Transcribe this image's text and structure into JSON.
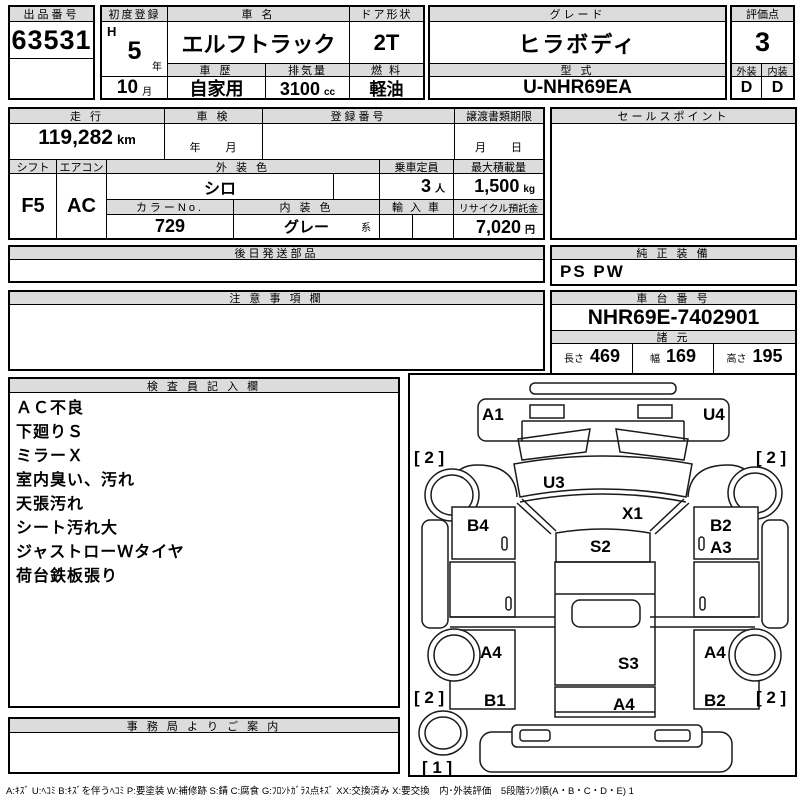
{
  "top": {
    "lot": {
      "label": "出品番号",
      "value": "63531"
    },
    "first_reg": {
      "label": "初度登録",
      "era": "H",
      "year": "5",
      "year_unit": "年",
      "month": "10",
      "month_unit": "月"
    },
    "car_name": {
      "label": "車 名",
      "value": "エルフトラック"
    },
    "history": {
      "label": "車 歴",
      "value": "自家用"
    },
    "displacement": {
      "label": "排気量",
      "value": "3100",
      "unit": "cc"
    },
    "door": {
      "label": "ドア形状",
      "value": "2T"
    },
    "fuel": {
      "label": "燃 料",
      "value": "軽油"
    },
    "grade": {
      "label": "グレード",
      "value": "ヒラボディ"
    },
    "model_code": {
      "label": "型 式",
      "value": "U-NHR69EA"
    },
    "score": {
      "label": "評価点",
      "value": "3"
    },
    "exterior": {
      "label": "外装",
      "value": "D"
    },
    "interior": {
      "label": "内装",
      "value": "D"
    }
  },
  "info": {
    "mileage": {
      "label": "走 行",
      "value": "119,282",
      "unit": "km"
    },
    "shaken": {
      "label": "車 検",
      "value": "年　　月"
    },
    "reg_no": {
      "label": "登録番号",
      "value": ""
    },
    "transfer_due": {
      "label": "譲渡書類期限",
      "value": "月　　日"
    },
    "shift": {
      "label": "シフト",
      "value": "F5"
    },
    "aircon": {
      "label": "エアコン",
      "value": "AC"
    },
    "ext_color": {
      "label": "外 装 色",
      "value": "シロ"
    },
    "color_no": {
      "label": "カラーNo.",
      "value": "729"
    },
    "int_color": {
      "label": "内 装 色",
      "value": "グレー",
      "suffix": "系"
    },
    "capacity": {
      "label": "乗車定員",
      "value": "3",
      "unit": "人"
    },
    "max_load": {
      "label": "最大積載量",
      "value": "1,500",
      "unit": "kg"
    },
    "import_car": {
      "label": "輸 入 車",
      "value": ""
    },
    "recycle": {
      "label": "リサイクル預託金",
      "value": "7,020",
      "unit": "円"
    },
    "sales_point": {
      "label": "セールスポイント",
      "value": ""
    }
  },
  "sections": {
    "later_parts": {
      "label": "後日発送部品",
      "value": ""
    },
    "genuine_equip": {
      "label": "純 正 装 備",
      "value": "PS PW"
    },
    "notes": {
      "label": "注 意 事 項 欄",
      "value": ""
    },
    "chassis": {
      "label": "車 台 番 号",
      "value": "NHR69E-7402901"
    },
    "specs": {
      "label": "諸 元",
      "length_label": "長さ",
      "length": "469",
      "width_label": "幅",
      "width": "169",
      "height_label": "高さ",
      "height": "195"
    },
    "inspector": {
      "label": "検 査 員 記 入 欄",
      "lines": [
        "ＡＣ不良",
        "下廻りＳ",
        "ミラーＸ",
        "室内臭い、汚れ",
        "天張汚れ",
        "シート汚れ大",
        "ジャストローＷタイヤ",
        "荷台鉄板張り"
      ]
    },
    "office": {
      "label": "事 務 局 よ り ご 案 内",
      "value": ""
    }
  },
  "diagram": {
    "labels": {
      "a1": "A1",
      "u4": "U4",
      "u3": "U3",
      "x1": "X1",
      "s2": "S2",
      "b4": "B4",
      "b2_door": "B2",
      "a3": "A3",
      "a4_left": "A4",
      "a4_right": "A4",
      "s3": "S3",
      "a4_gate": "A4",
      "b1": "B1",
      "b2_rear": "B2",
      "tire_fl": "[ 2 ]",
      "tire_fr": "[ 2 ]",
      "tire_rl": "[ 2 ]",
      "tire_rr": "[ 2 ]",
      "spare": "[ 1 ]"
    }
  },
  "legend": "A:ｷｽﾞ U:ﾍｺﾐ B:ｷｽﾞを伴うﾍｺﾐ P:要塗装 W:補修跡 S:錆 C:腐食 G:ﾌﾛﾝﾄｶﾞﾗｽ点ｷｽﾞ XX:交換済み X:要交換　内･外装評価　5段階ﾗﾝｸ順(A・B・C・D・E) 1"
}
